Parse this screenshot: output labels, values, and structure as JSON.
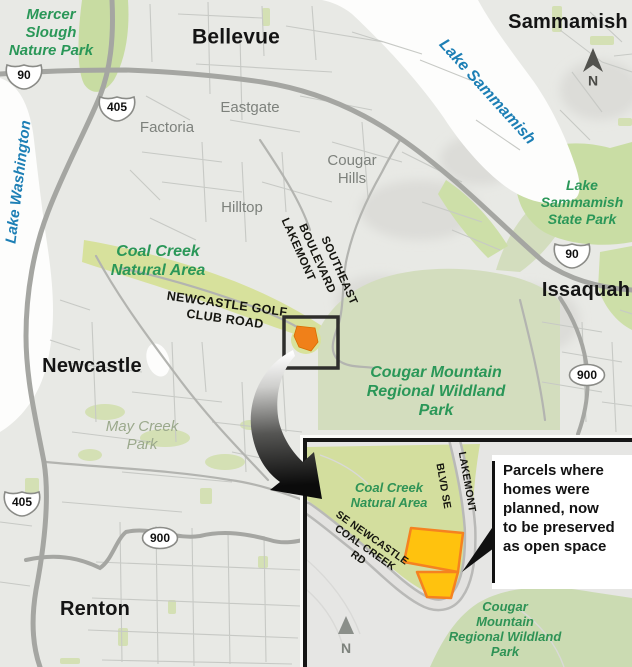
{
  "main_map": {
    "cities": {
      "bellevue": "Bellevue",
      "sammamish": "Sammamish",
      "issaquah": "Issaquah",
      "newcastle": "Newcastle",
      "renton": "Renton"
    },
    "districts": {
      "eastgate": "Eastgate",
      "factoria": "Factoria",
      "hilltop": "Hilltop",
      "cougar_hills": "Cougar\nHills"
    },
    "parks": {
      "mercer_slough": "Mercer\nSlough\nNature Park",
      "coal_creek": "Coal Creek\nNatural Area",
      "lake_sammamish_state_park": "Lake\nSammamish\nState Park",
      "cougar_mountain": "Cougar Mountain\nRegional Wildland\nPark",
      "may_creek": "May Creek\nPark"
    },
    "waters": {
      "lake_washington": "Lake Washington",
      "lake_sammamish": "Lake Sammamish"
    },
    "roads": {
      "lakemont_word1": "LAKEMONT",
      "lakemont_word2": "BOULEVARD",
      "lakemont_word3": "SOUTHEAST",
      "newcastle_golf": "NEWCASTLE GOLF\nCLUB ROAD"
    },
    "shields": [
      {
        "route": "90"
      },
      {
        "route": "405"
      },
      {
        "route": "90"
      },
      {
        "route": "900"
      },
      {
        "route": "405"
      },
      {
        "route": "900"
      }
    ],
    "north": "N"
  },
  "inset": {
    "parks": {
      "coal_creek": "Coal Creek\nNatural Area",
      "cougar_mountain": "Cougar\nMountain\nRegional Wildland\nPark"
    },
    "roads": {
      "lakemont": "LAKEMONT",
      "blvd_se": "BLVD SE",
      "se_newcastle_coal_creek_rd": "SE NEWCASTLE\nCOAL CREEK\nRD"
    },
    "callout": "Parcels where\nhomes were\nplanned, now\nto be preserved\nas open space",
    "north": "N"
  },
  "colors": {
    "park_label_green": "#2A9758",
    "water_label_blue": "#1D7FB5",
    "urban_gray": "#E8E9E5",
    "park_fill_green": "#D3DDBE",
    "corridor_green": "#D7E19C",
    "parcel_fill_yellow": "#FFC20E",
    "parcel_outline_orange": "#F58220",
    "marker_parcel_orange": "#F08019",
    "highway_gray": "#A5A6A2"
  }
}
